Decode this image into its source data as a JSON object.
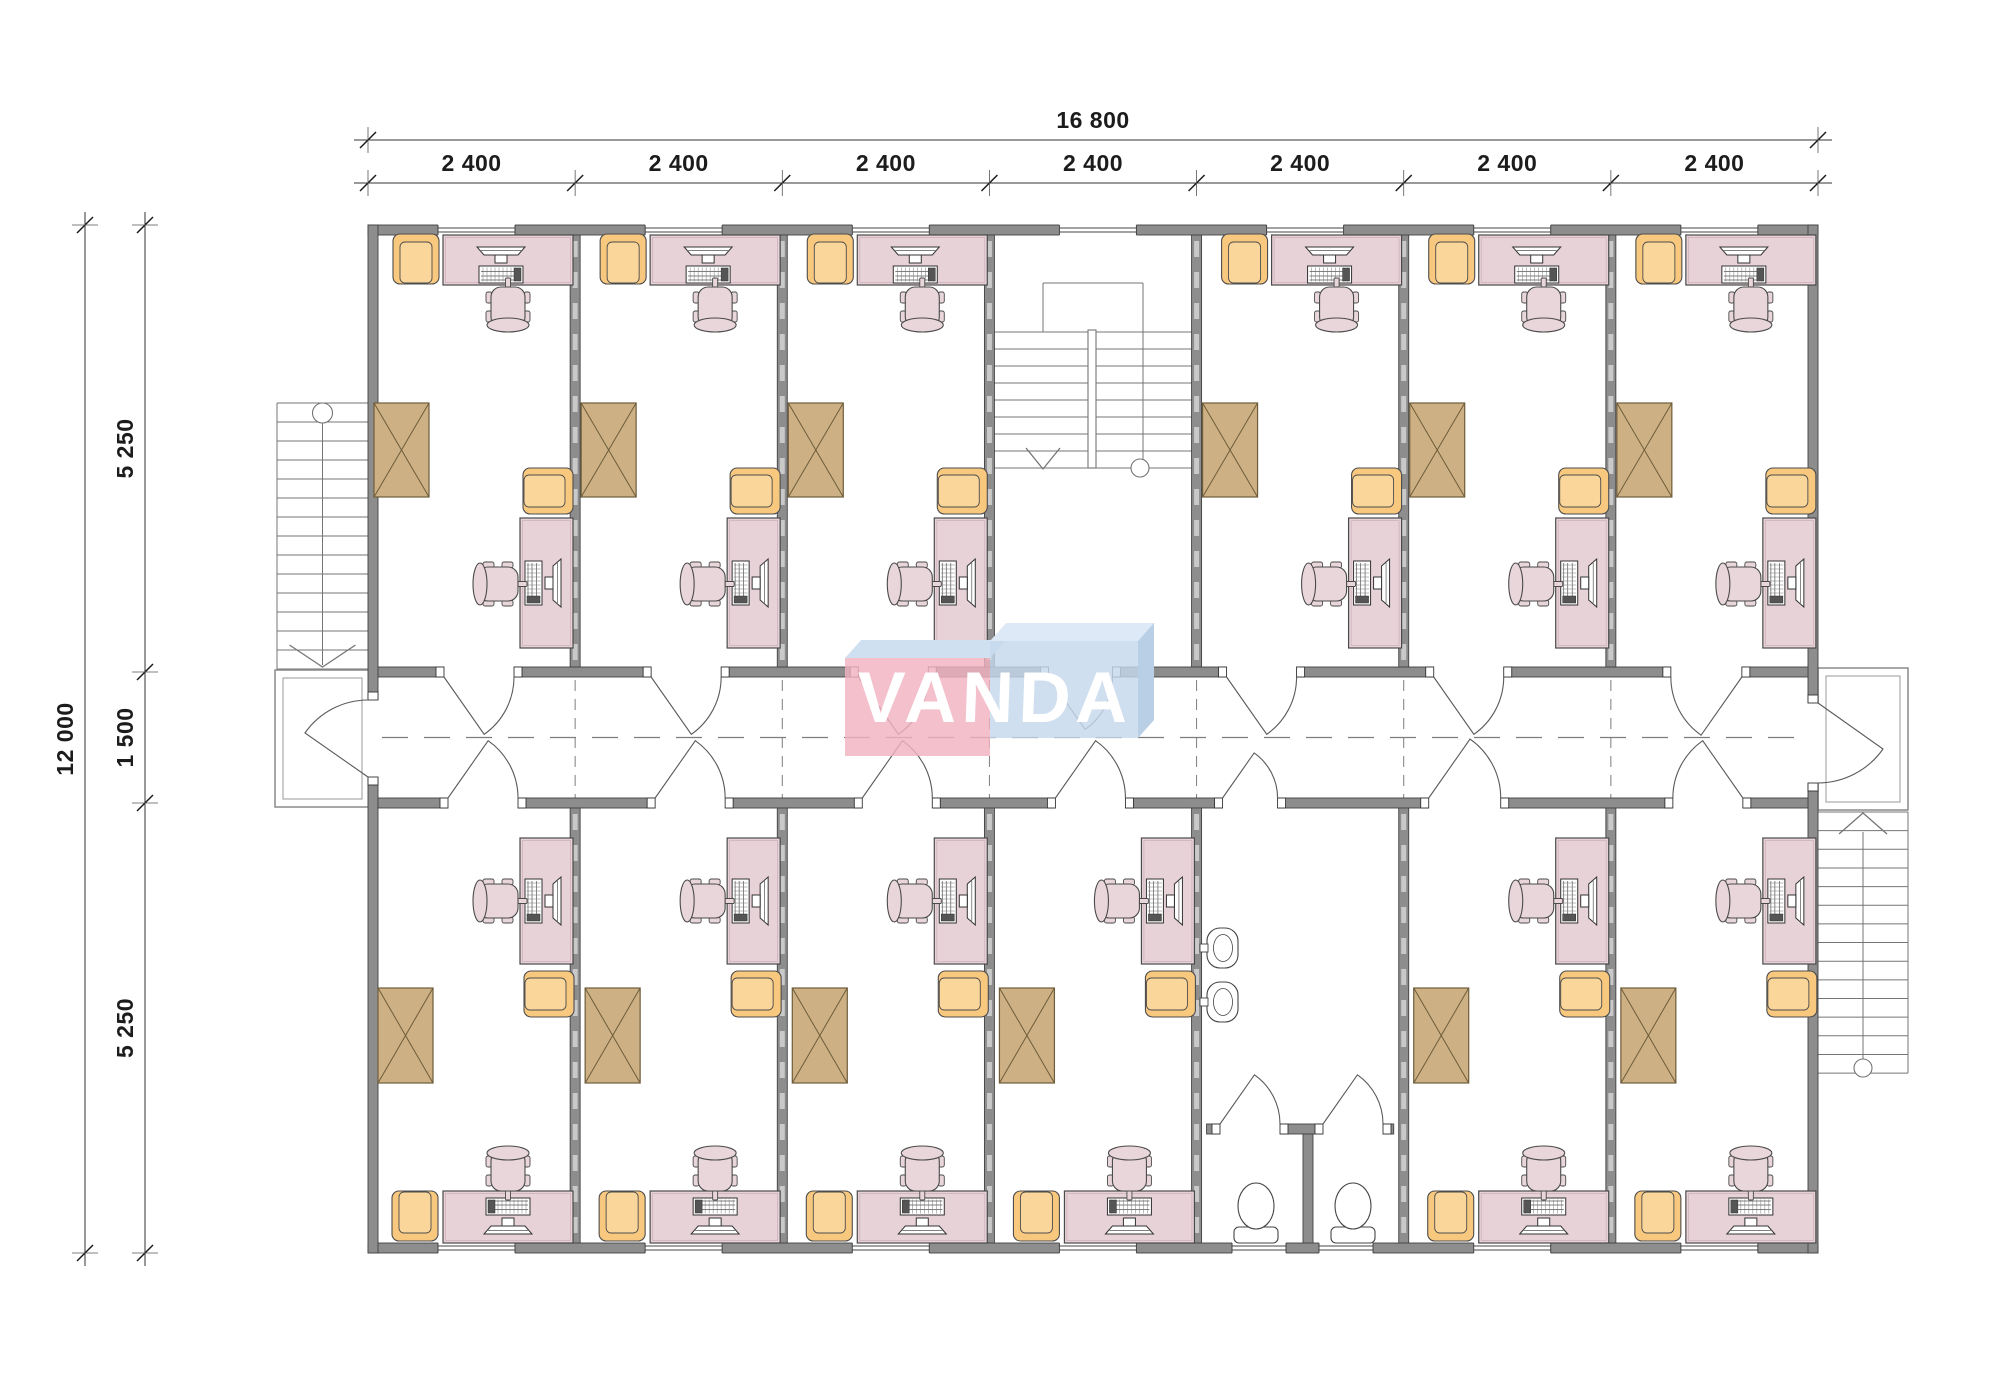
{
  "page": {
    "width": 2000,
    "height": 1380,
    "background": "#ffffff"
  },
  "watermark": {
    "text": "VANDA",
    "front_left_color": "rgba(242,178,192,0.82)",
    "front_right_color": "rgba(198,216,236,0.82)",
    "top_left_color": "#cfe0f1",
    "top_right_color": "#dde9f6",
    "side_right_color": "#b9cfe5",
    "text_color": "#ffffff"
  },
  "dimensions": {
    "top_total_label": "16 800",
    "top_bay_labels": [
      "2 400",
      "2 400",
      "2 400",
      "2 400",
      "2 400",
      "2 400",
      "2 400"
    ],
    "left_total_label": "12 000",
    "left_segment_labels": [
      "5 250",
      "1 500",
      "5 250"
    ]
  },
  "building": {
    "total_width_mm": 16800,
    "total_depth_mm": 12000,
    "bay_width_mm": 2400,
    "bay_count": 7,
    "corridor_width_mm": 1500,
    "room_depth_mm": 5250,
    "rooms_top": [
      "office",
      "office",
      "office",
      "stairwell",
      "office",
      "office",
      "office"
    ],
    "rooms_bottom": [
      "office",
      "office",
      "office",
      "office",
      "washroom",
      "office",
      "office"
    ],
    "summary": {
      "offices": 12,
      "internal_stairwells": 1,
      "washrooms": 1,
      "external_stairs": 2,
      "washbasins": 2,
      "toilets": 2
    }
  },
  "colors": {
    "wall": "#8d8d8d",
    "wall_edge": "#424242",
    "stud_dash": "#c9c9c9",
    "desk": "#e7d2d7",
    "desk_edge": "#4a4a4a",
    "desk_inner": "#c9aeb6",
    "chair": "#e9d6da",
    "armchair": "#f8c87e",
    "armchair_seat": "#fbd69b",
    "armchair_edge": "#4d4d4d",
    "cabinet": "#cdb184",
    "cabinet_edge": "#6e5c3a",
    "fixture_edge": "#444444",
    "stair_line": "#757575",
    "door": "#5a5a5a",
    "dash_line": "#7d7d7d",
    "window_line": "#444444",
    "dim": "#1c1c1c"
  },
  "plan": {
    "x0": 368,
    "x1": 1818,
    "y_top": 225,
    "y_bottom": 1253,
    "wall": 10,
    "corridor_y1": 667,
    "corridor_y2": 808,
    "top_doors": [
      {
        "bay": 0,
        "a": 76,
        "b": 146,
        "hinge": "L"
      },
      {
        "bay": 1,
        "a": 76,
        "b": 146,
        "hinge": "L"
      },
      {
        "bay": 2,
        "a": 76,
        "b": 146,
        "hinge": "L"
      },
      {
        "bay": 3,
        "a": 59,
        "b": 123,
        "hinge": "L"
      },
      {
        "bay": 4,
        "a": 30,
        "b": 100,
        "hinge": "L"
      },
      {
        "bay": 5,
        "a": 30,
        "b": 100,
        "hinge": "L"
      },
      {
        "bay": 6,
        "a": 60,
        "b": 131,
        "hinge": "R"
      }
    ],
    "bottom_doors": [
      {
        "bay": 0,
        "a": 80,
        "b": 150,
        "hinge": "L"
      },
      {
        "bay": 1,
        "a": 80,
        "b": 150,
        "hinge": "L"
      },
      {
        "bay": 2,
        "a": 80,
        "b": 150,
        "hinge": "L"
      },
      {
        "bay": 3,
        "a": 66,
        "b": 136,
        "hinge": "L"
      },
      {
        "bay": 4,
        "a": 26,
        "b": 81,
        "hinge": "L"
      },
      {
        "bay": 5,
        "a": 25,
        "b": 97,
        "hinge": "L"
      },
      {
        "bay": 6,
        "a": 62,
        "b": 132,
        "hinge": "R"
      }
    ],
    "side_doors": {
      "left": [
        700,
        777
      ],
      "right": [
        703,
        783
      ]
    },
    "window_offset": [
      70,
      147
    ],
    "top_window_bays": [
      0,
      1,
      2,
      3,
      4,
      5,
      6
    ],
    "bottom_window_bays": [
      0,
      1,
      2,
      3,
      5,
      6
    ],
    "stairwell_bay": 3,
    "washroom_bay": 4,
    "furniture_top_bays": [
      0,
      1,
      2,
      4,
      5,
      6
    ],
    "furniture_bottom_bays": [
      0,
      1,
      2,
      3,
      5,
      6
    ],
    "furniture_layout": {
      "office_top": {
        "armchair_corner": [
          48,
          259,
          180
        ],
        "desk_top": [
          75,
          235,
          130,
          50
        ],
        "pc_top": [
          133,
          262,
          0
        ],
        "chair_top": [
          140,
          307,
          0
        ],
        "cabinet": [
          6,
          403,
          55,
          94
        ],
        "armchair_mid": [
          180,
          491,
          -90
        ],
        "desk_side": [
          152,
          518,
          53,
          130
        ],
        "pc_side": [
          178,
          583,
          90
        ],
        "chair_side": [
          130,
          584,
          90
        ]
      },
      "office_bottom": {
        "desk_side": [
          152,
          838,
          53,
          126
        ],
        "pc_side": [
          178,
          901,
          90
        ],
        "chair_side": [
          130,
          901,
          90
        ],
        "armchair_mid": [
          181,
          994,
          -90
        ],
        "cabinet": [
          10,
          988,
          55,
          95
        ],
        "desk_bottom": [
          75,
          1191,
          130,
          52
        ],
        "pc_bottom": [
          140,
          1219,
          180
        ],
        "chair_bottom": [
          140,
          1171,
          180
        ],
        "armchair_corner": [
          47,
          1216,
          0
        ]
      }
    },
    "washroom": {
      "sink_wall_x": 1206,
      "sink_y": [
        948,
        1002
      ],
      "stall_wall_y": 1124,
      "stall_openings": [
        [
          1220,
          1280
        ],
        [
          1323,
          1383
        ]
      ],
      "partition_x": 1303,
      "toilet_cx": [
        1256,
        1353
      ],
      "window_x": [
        [
          1232,
          1286
        ],
        [
          1319,
          1373
        ]
      ]
    },
    "stair_left": {
      "x1": 277,
      "x2": 368,
      "y1": 403,
      "y2": 670,
      "porch": [
        275,
        670,
        95,
        137
      ]
    },
    "stair_right": {
      "x1": 1818,
      "x2": 1908,
      "y1": 812,
      "y2": 1073,
      "porch": [
        1818,
        668,
        90,
        142
      ]
    },
    "stair_internal": {
      "landing": [
        1043,
        283,
        100,
        47
      ],
      "x1": 992,
      "x2": 1197,
      "y1": 332,
      "y2": 468,
      "rail_x": 1088
    },
    "centerline_y": 737.5
  }
}
